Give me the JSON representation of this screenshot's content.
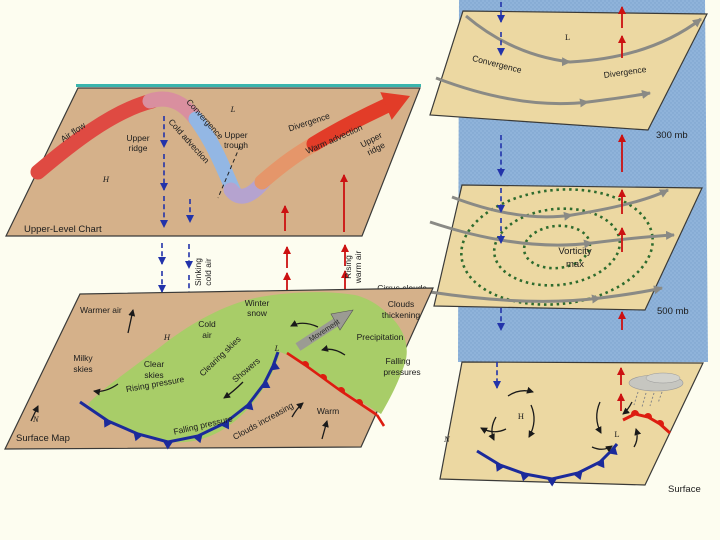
{
  "colors": {
    "background": "#FDFDF0",
    "panel_tan_left": "#D5B18A",
    "panel_tan_right": "#ECD8A2",
    "sky_blue": "#8FB3DA",
    "green_cloud_shield": "#A8CD68",
    "cold_front_blue": "#1B2A9B",
    "warm_front_red": "#DD1D10",
    "jet_red": "#DF4A42",
    "jet_blue": "#93B7E4",
    "sinking_arrow_blue": "#2233AA",
    "rising_arrow_red": "#CC1111",
    "streamline_gray": "#8A8A85",
    "vorticity_green": "#2E6B2E",
    "teal_edge": "#3AB5AD"
  },
  "left_diagram": {
    "upper_panel": {
      "title": "Upper-Level Chart",
      "air_flow": "Air flow",
      "convergence": "Convergence",
      "cold_advection": "Cold advection",
      "upper_ridge_left": [
        "Upper",
        "ridge"
      ],
      "high": "H",
      "low": "L",
      "upper_trough": [
        "Upper",
        "trough"
      ],
      "divergence": "Divergence",
      "warm_advection": "Warm advection",
      "upper_ridge_right": [
        "Upper",
        "ridge"
      ]
    },
    "between": {
      "sinking": [
        "Sinking",
        "cold air"
      ],
      "rising": [
        "Rising",
        "warm air"
      ],
      "cirrus_clouds": "Cirrus clouds"
    },
    "surface_panel": {
      "title": "Surface Map",
      "north": "N",
      "warmer_air": "Warmer air",
      "high": "H",
      "cold_air": [
        "Cold",
        "air"
      ],
      "milky_skies": [
        "Milky",
        "skies"
      ],
      "clear_skies": [
        "Clear",
        "skies"
      ],
      "rising_pressure": "Rising pressure",
      "clearing_skies": "Clearing skies",
      "showers": "Showers",
      "winter_snow": [
        "Winter",
        "snow"
      ],
      "low": "L",
      "movement": "Movement",
      "precipitation": "Precipitation",
      "falling_pressures": [
        "Falling",
        "pressures"
      ],
      "clouds_thickening": [
        "Clouds",
        "thickening"
      ],
      "falling_pressure": "Falling pressure",
      "clouds_increasing": "Clouds increasing",
      "warm": "Warm"
    }
  },
  "right_diagram": {
    "level_300": {
      "low": "L",
      "convergence": "Convergence",
      "divergence": "Divergence",
      "label": "300 mb"
    },
    "level_500": {
      "vorticity": [
        "Vorticity",
        "max"
      ],
      "label": "500 mb"
    },
    "surface": {
      "high": "H",
      "low": "L",
      "north": "N",
      "label": "Surface"
    }
  }
}
